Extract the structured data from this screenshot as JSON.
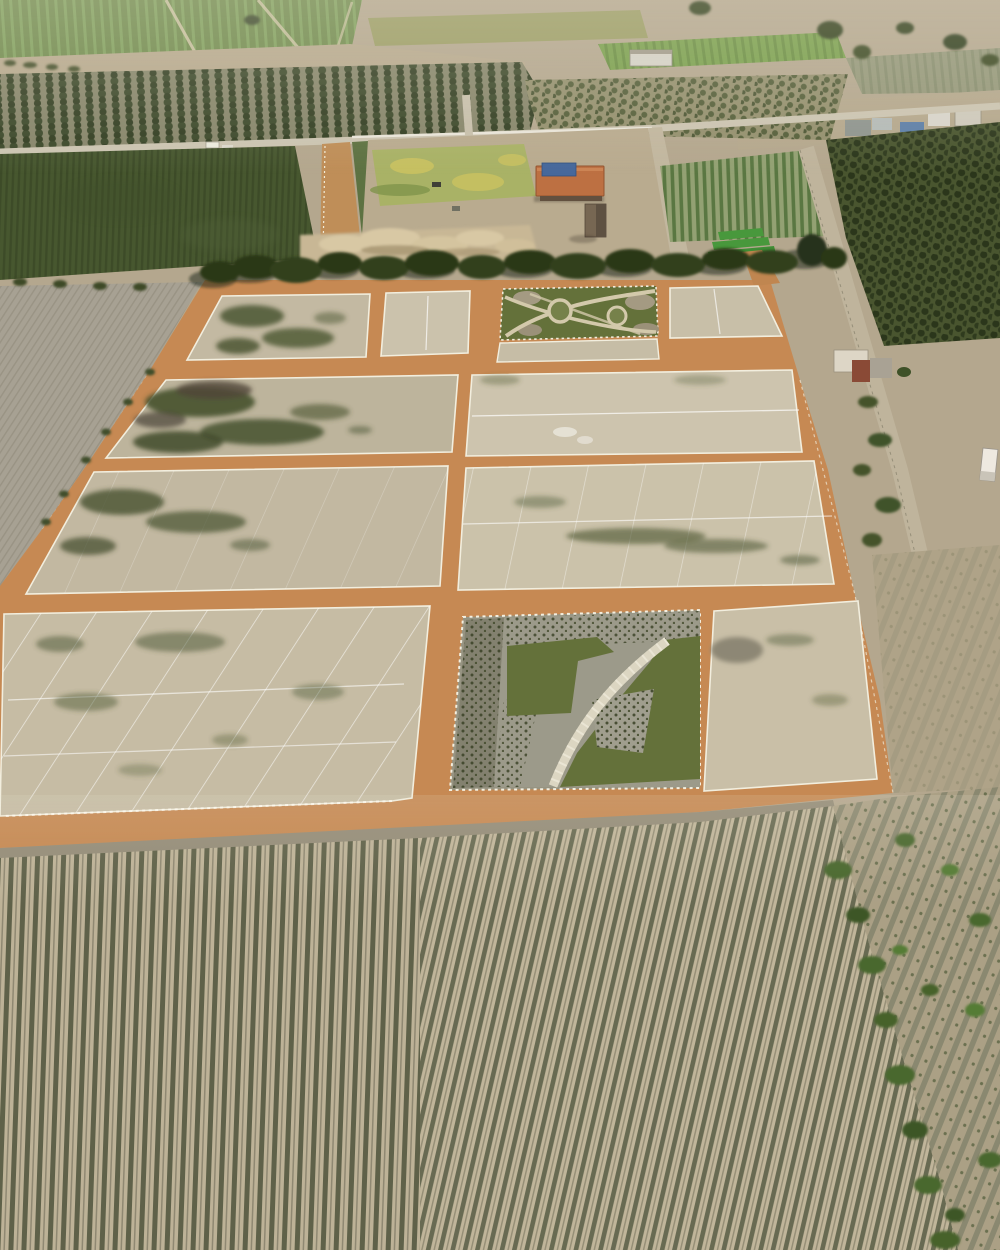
{
  "image": {
    "kind": "aerial drone photograph",
    "width_px": 1000,
    "height_px": 1250,
    "visible_text": "none"
  },
  "palette": {
    "base_earth": "#b4a78e",
    "road_dirt_orange": "#c68953",
    "plot_sand": "#cdc4ae",
    "plot_sand_dark": "#bdb49c",
    "lot_line_white": "#f2eede",
    "cane_green": "#47572f",
    "orchard_green": "#49552f",
    "lawn_green": "#a9b266",
    "roof_orange": "#bd7042",
    "roof_blue": "#47689b",
    "park_green": "#64713a",
    "park_gravel": "#9c9a8a",
    "tree_canopy": "#2c3819",
    "furrow_ridge": "#bdb297",
    "furrow_trench": "#5f6149",
    "weedy_field": "#aba085",
    "shrub_green": "#4a672e",
    "track_gray": "#ccc5b2"
  },
  "scene": {
    "regions": [
      {
        "id": "far-farmland",
        "label": "distant crop fields and farm buildings"
      },
      {
        "id": "orchard-band",
        "label": "orchard tree rows"
      },
      {
        "id": "cane-field",
        "label": "dense green cane field"
      },
      {
        "id": "farm-compound",
        "label": "farmyard with orange-roof building"
      },
      {
        "id": "vineyard",
        "label": "vineyard rows"
      },
      {
        "id": "right-orchard",
        "label": "dark orchard block"
      },
      {
        "id": "subdivision",
        "label": "lot subdivision with orange dirt roads and white-staked plots"
      },
      {
        "id": "top-park",
        "label": "small landscaped park parcel"
      },
      {
        "id": "central-park",
        "label": "landscaped park with curved walkway"
      },
      {
        "id": "tree-line",
        "label": "row of shade trees along the site"
      },
      {
        "id": "furrow-field",
        "label": "furrowed crop field in foreground"
      },
      {
        "id": "weedy-field",
        "label": "weedy fallow field with shrubs"
      }
    ]
  }
}
